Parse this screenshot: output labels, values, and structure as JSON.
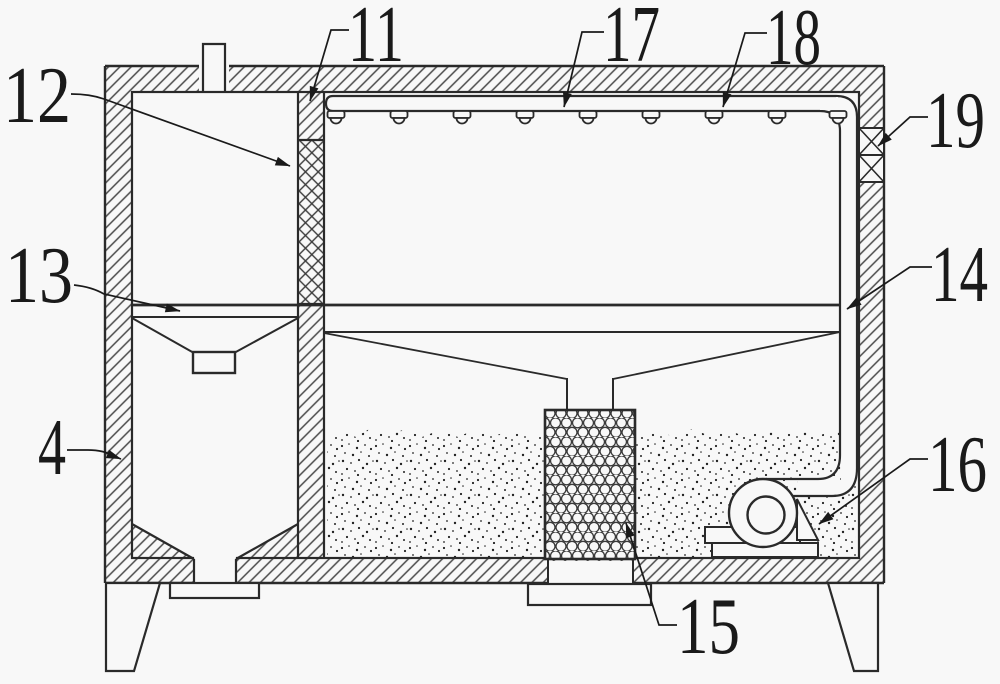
{
  "figure": {
    "background": "#f8f8f8",
    "line_color": "#2a2a2a",
    "hatch_color": "#4a4a4a",
    "labels": [
      {
        "id": "4",
        "text": "4"
      },
      {
        "id": "11",
        "text": "11"
      },
      {
        "id": "12",
        "text": "12"
      },
      {
        "id": "13",
        "text": "13"
      },
      {
        "id": "14",
        "text": "14"
      },
      {
        "id": "15",
        "text": "15"
      },
      {
        "id": "16",
        "text": "16"
      },
      {
        "id": "17",
        "text": "17"
      },
      {
        "id": "18",
        "text": "18"
      },
      {
        "id": "19",
        "text": "19"
      }
    ]
  }
}
